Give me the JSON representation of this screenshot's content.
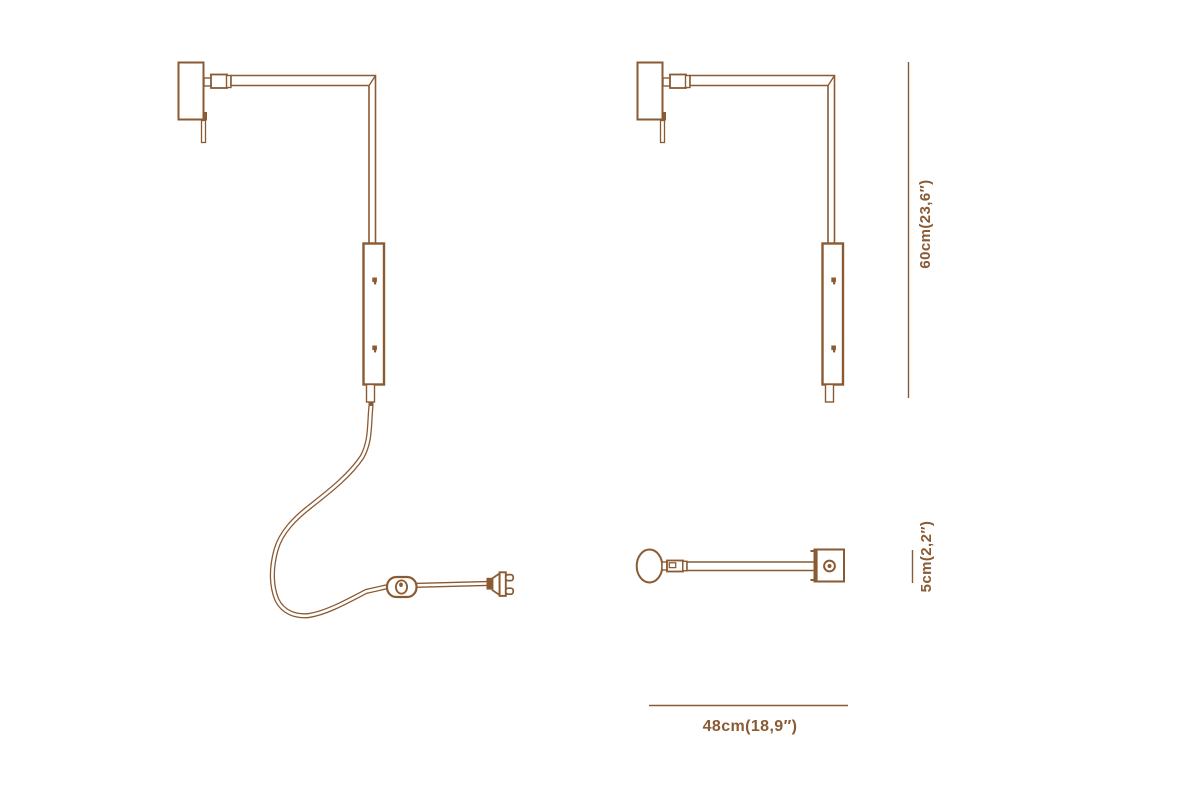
{
  "diagram": {
    "background": "#ffffff",
    "line_color": "#8a5a33",
    "dimensions": {
      "height": "60cm(23,6″)",
      "depth": "5cm(2,2″)",
      "width": "48cm(18,9″)"
    }
  }
}
